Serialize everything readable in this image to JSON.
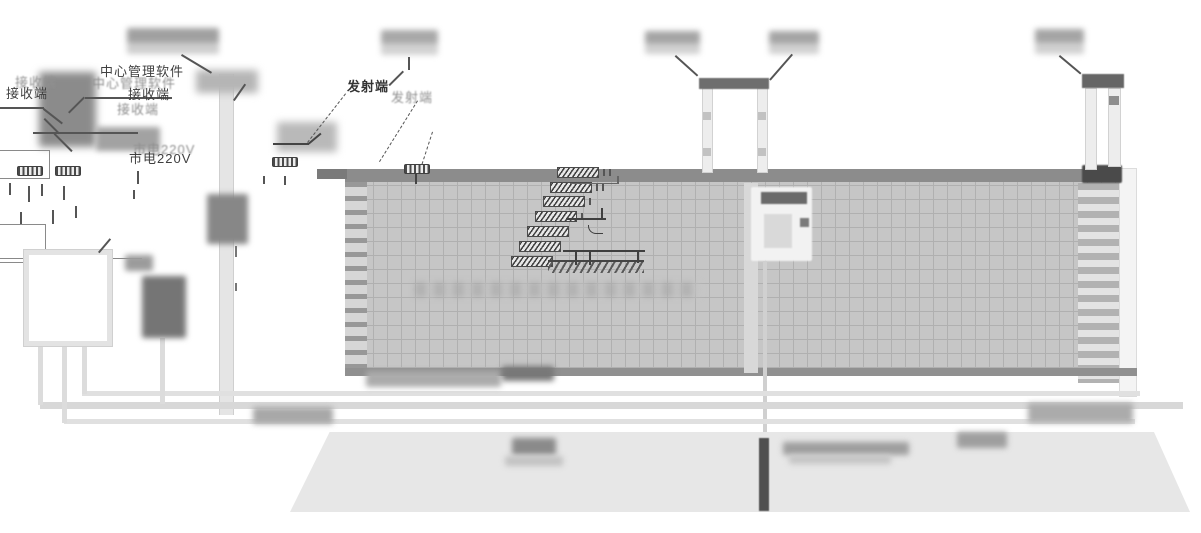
{
  "diagram": {
    "title": "perimeter-security-fence-installation-diagram",
    "labels": {
      "management_software": "中心管理软件",
      "receiver": "接收端",
      "transmitter": "发射端",
      "mains_power": "市电220V"
    },
    "colors": {
      "fence_mesh": "#c6c6c6",
      "fence_rail": "#8c8c8c",
      "fence_bottom_rail": "#909090",
      "ground": "#e7e7e7",
      "line": "#555555",
      "blurred_label": "#a0a0a0",
      "dark_device": "#757575",
      "conduit": "#4f4f4f"
    }
  }
}
